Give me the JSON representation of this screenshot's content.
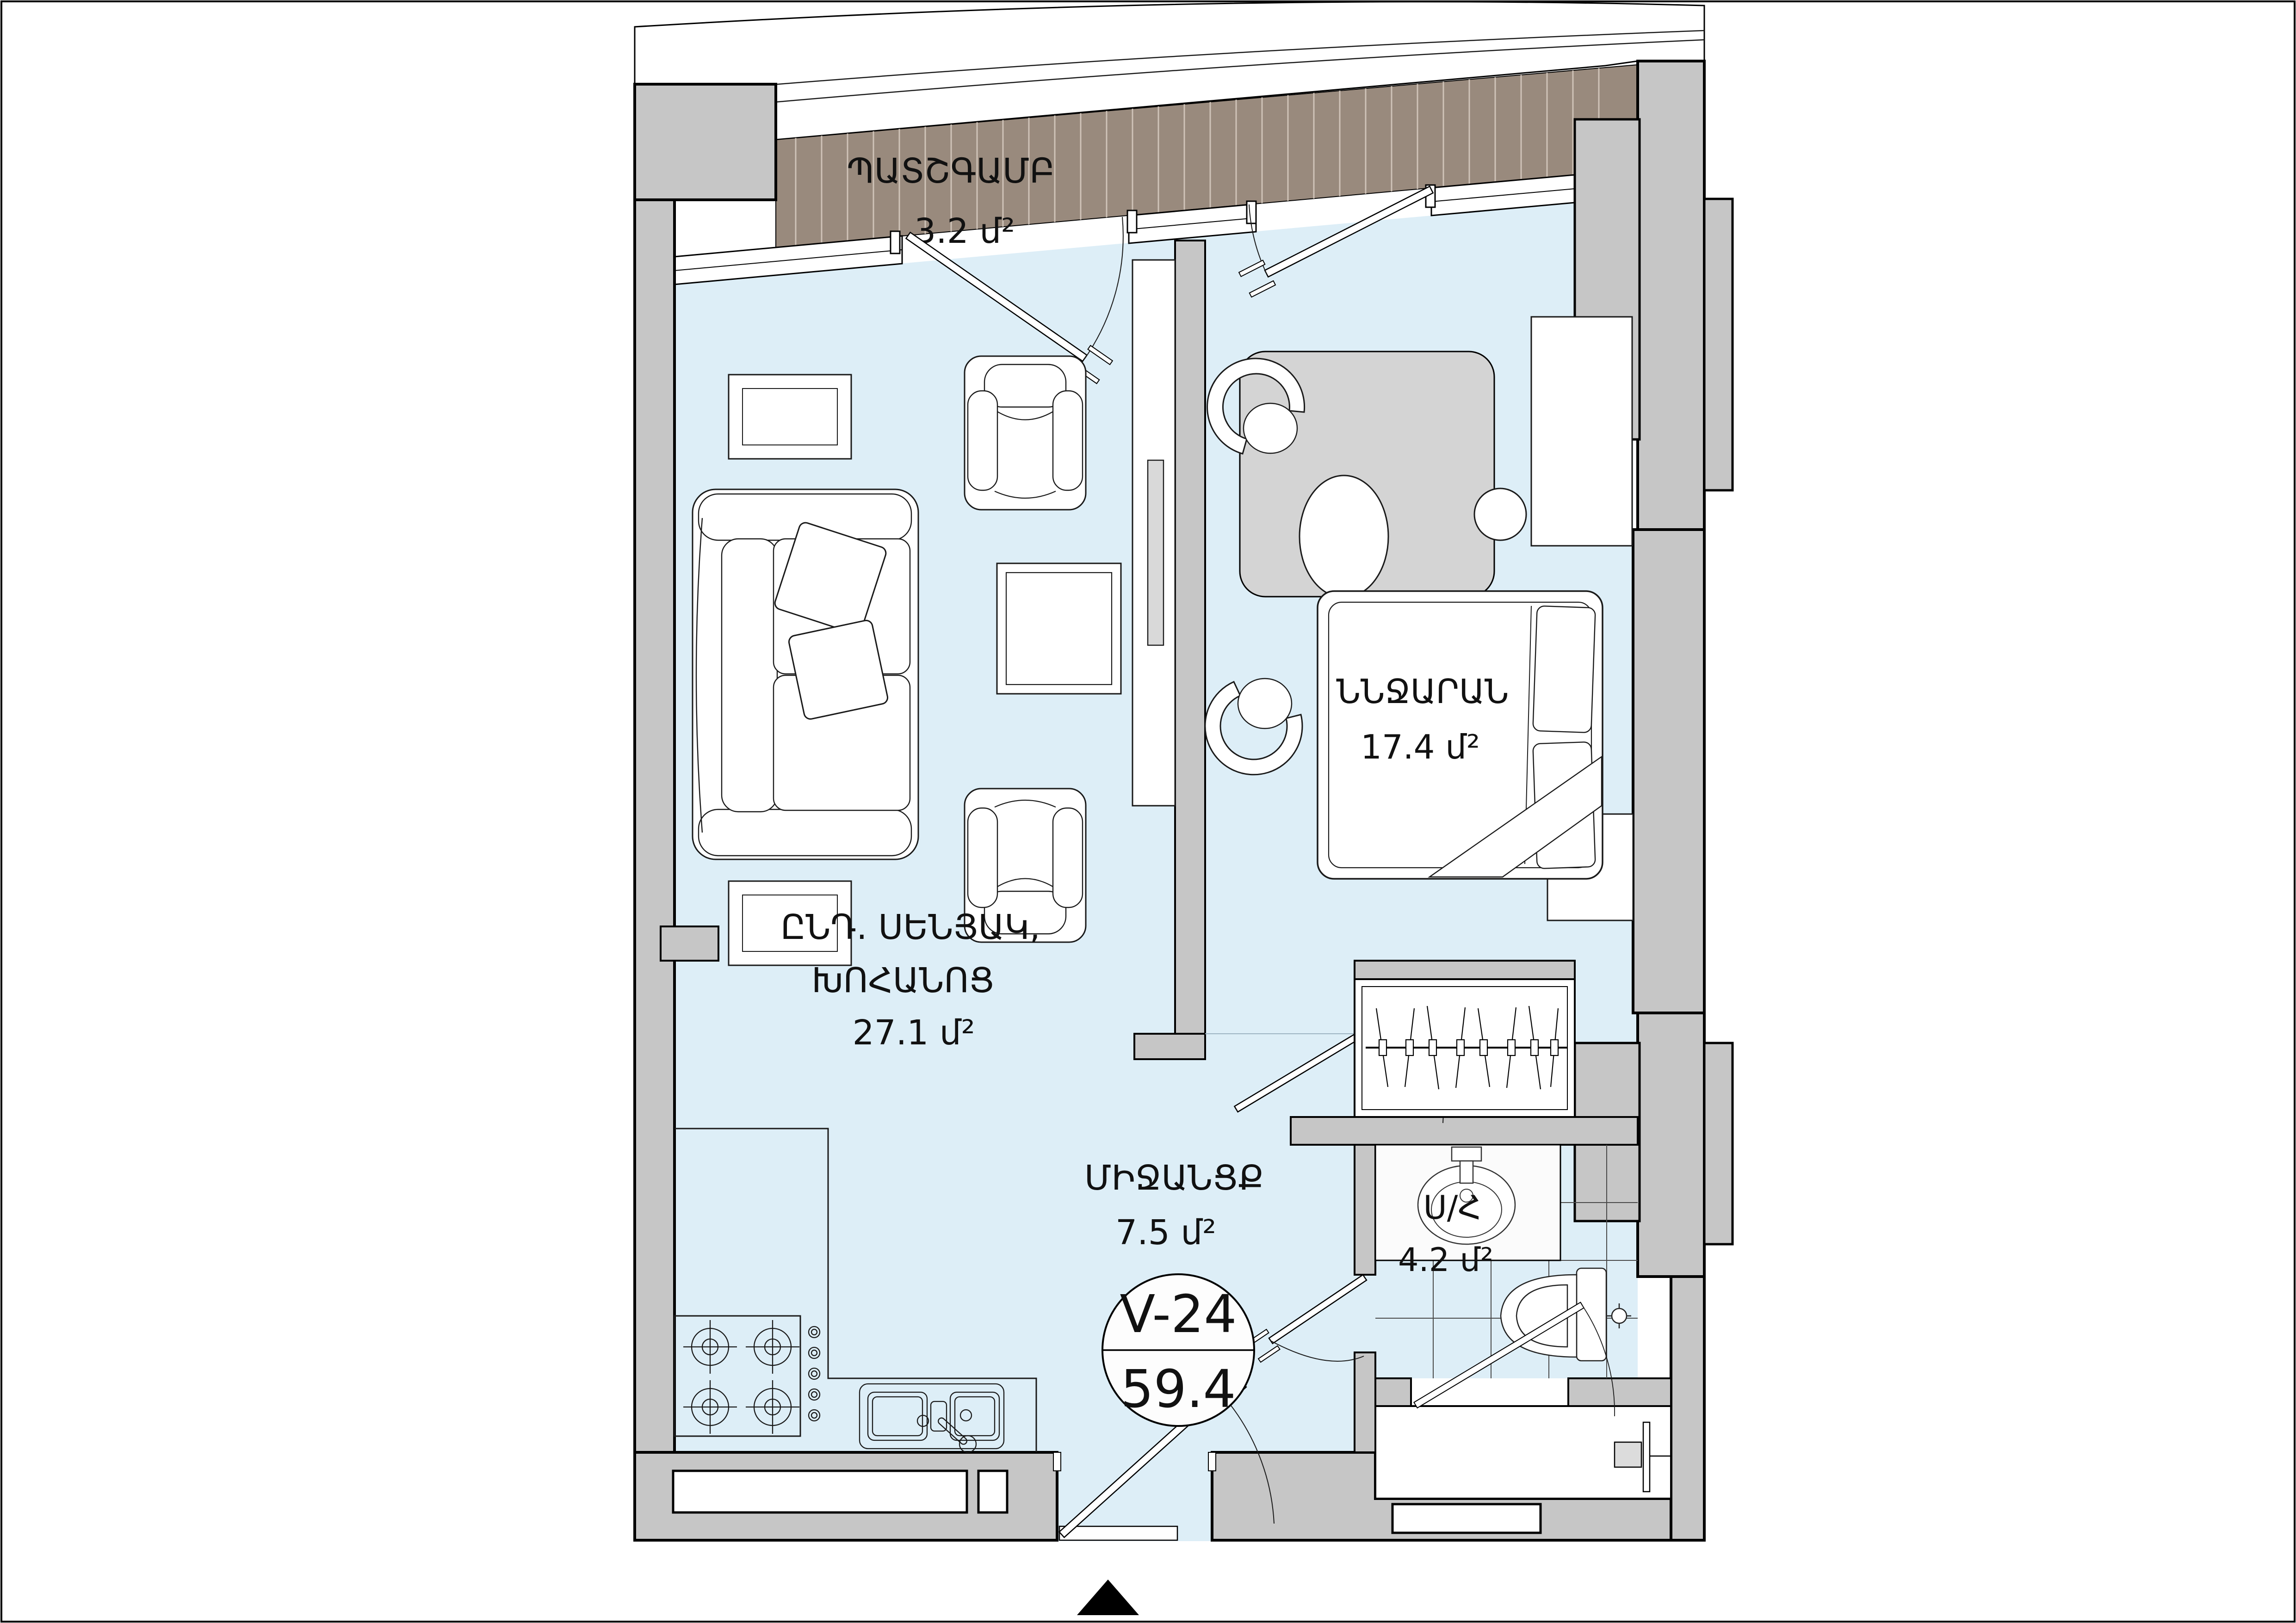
{
  "badge": {
    "unit": "V-24",
    "area": "59.4"
  },
  "rooms": {
    "balcony": {
      "name": "ՊԱՏՇԳԱՄԲ",
      "area": "3.2 մ²"
    },
    "living": {
      "name_line1": "ԸՆԴ. ՍԵՆՅԱԿ,",
      "name_line2": "ԽՈՀԱՆՈՑ",
      "area": "27.1 մ²"
    },
    "bedroom": {
      "name": "ՆՆՋԱՐԱՆ",
      "area": "17.4 մ²"
    },
    "hallway": {
      "name": "ՄԻՋԱՆՑՔ",
      "area": "7.5 մ²"
    },
    "bathroom": {
      "name": "Ս/Հ",
      "area": "4.2 մ²"
    }
  },
  "colors": {
    "floor": "#ddeef7",
    "wall": "#c6c6c6",
    "balcony_deck": "#998a7d",
    "balcony_slat": "#cfc3b8",
    "rug": "#d4d4d4",
    "outline": "#000000",
    "tile_line": "#4a4a4a"
  }
}
